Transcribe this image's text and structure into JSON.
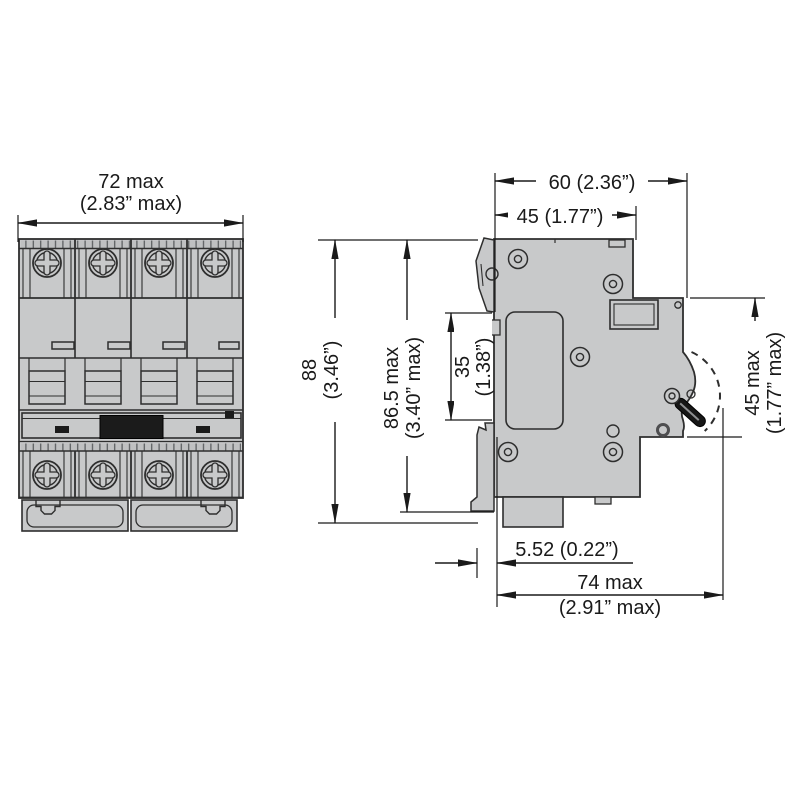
{
  "front_view": {
    "width_mm": "72 max",
    "width_in": "(2.83” max)"
  },
  "side_view": {
    "depth_total": "60 (2.36”)",
    "body_depth": "45 (1.77”)",
    "height_mm": "88",
    "height_in": "(3.46”)",
    "height_max_mm": "86.5 max",
    "height_max_in": "(3.40” max)",
    "recess_mm": "35",
    "recess_in": "(1.38”)",
    "front_mm": "45 max",
    "front_in": "(1.77” max)",
    "offset": "5.52 (0.22”)",
    "depth_max_mm": "74 max",
    "depth_max_in": "(2.91” max)"
  },
  "colors": {
    "body": "#c8c9ca",
    "outline": "#2e2e2e",
    "dimension": "#1a1a1a",
    "handle": "#161616"
  }
}
